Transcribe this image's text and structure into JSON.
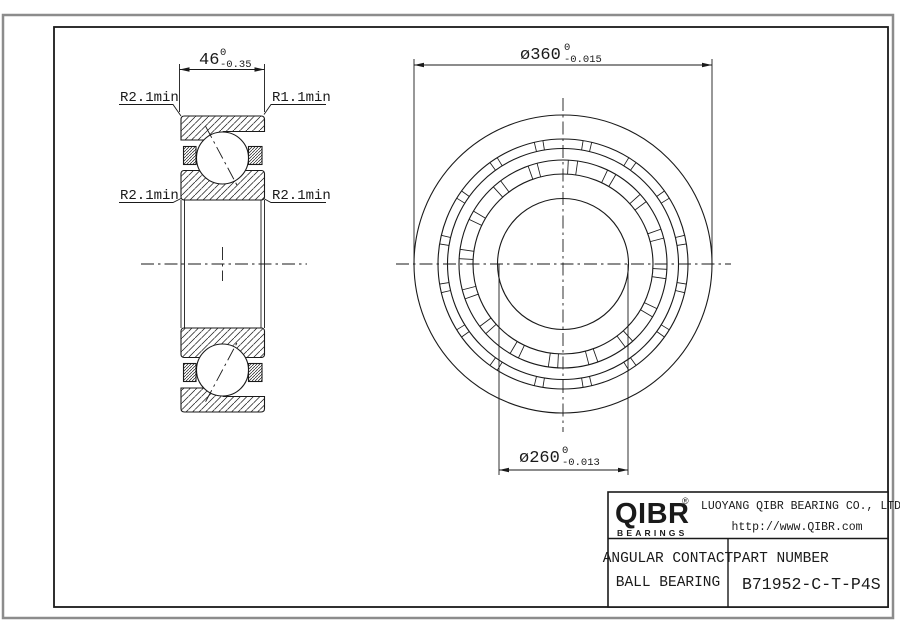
{
  "drawing": {
    "dims": {
      "width": {
        "label": "46",
        "tol_upper": "0",
        "tol_lower": "-0.35"
      },
      "outer_diameter": {
        "label": "ø360",
        "tol_upper": "0",
        "tol_lower": "-0.015"
      },
      "bore_diameter": {
        "label": "ø260",
        "tol_upper": "0",
        "tol_lower": "-0.013"
      }
    },
    "radius_labels": {
      "top_left": "R2.1min",
      "top_right": "R1.1min",
      "mid_left": "R2.1min",
      "mid_right": "R2.1min"
    }
  },
  "title_block": {
    "logo": "QIBR",
    "logo_registered": "®",
    "logo_sub": "BEARINGS",
    "company": "LUOYANG QIBR BEARING CO., LTD",
    "website": "http://www.QIBR.com",
    "product_line1": "ANGULAR CONTACT",
    "product_line2": "BALL BEARING",
    "part_number_label": "PART NUMBER",
    "part_number": "B71952-C-T-P4S"
  },
  "colors": {
    "line": "#1a1a1a",
    "border_gray": "#8c8c8c",
    "background": "#ffffff"
  }
}
